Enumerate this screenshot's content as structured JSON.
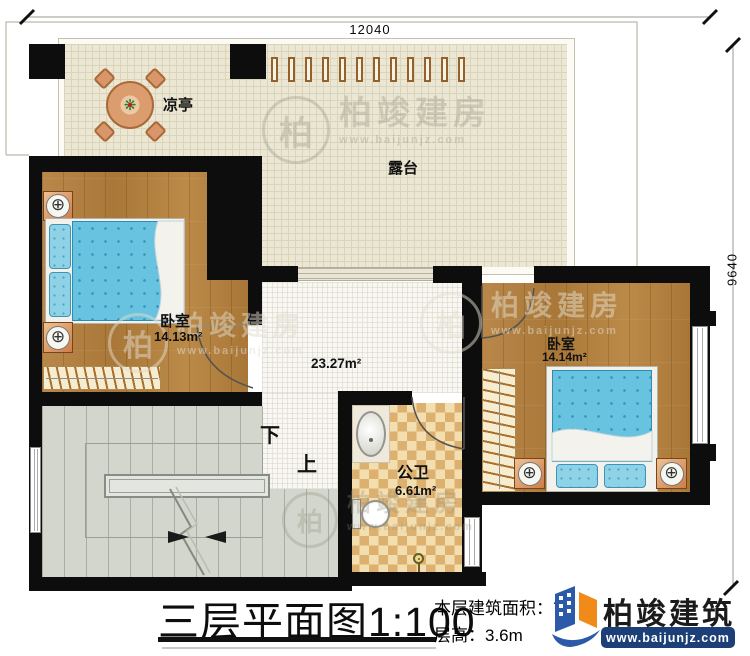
{
  "dims": {
    "width_label": "12040",
    "height_label": "9640"
  },
  "rooms": {
    "pavilion": {
      "label": "凉亭"
    },
    "terrace": {
      "label": "露台"
    },
    "bedroom_left": {
      "label": "卧室",
      "area": "14.13m²"
    },
    "bedroom_right": {
      "label": "卧室",
      "area": "14.14m²"
    },
    "hall": {
      "area": "23.27m²"
    },
    "bathroom": {
      "label": "公卫",
      "area": "6.61m²"
    }
  },
  "stairs": {
    "down_label": "下",
    "up_label": "上"
  },
  "footer": {
    "title": "三层平面图",
    "scale": "1:100",
    "area_line": "本层建筑面积：70",
    "height_line": "层高：3.6m"
  },
  "brand": {
    "name": "柏竣建筑",
    "site": "www.baijunjz.com"
  },
  "watermark": {
    "char": "柏",
    "name": "柏竣建房",
    "site": "www.baijunjz.com"
  },
  "icons": {
    "lamp": "⊕",
    "plant": "❋"
  },
  "colors": {
    "wall": "#0d0d0d",
    "wood": "#b2813f",
    "terrace": "#ece7d5",
    "stairs": "#d2d6cd",
    "tile_dark": "#dcb170",
    "tile_light": "#f3deb0",
    "bed_blue": "#67c3e0",
    "brand_navy": "#1c3f77",
    "brand_blue": "#2a5aa8",
    "brand_orange": "#f08a18"
  }
}
